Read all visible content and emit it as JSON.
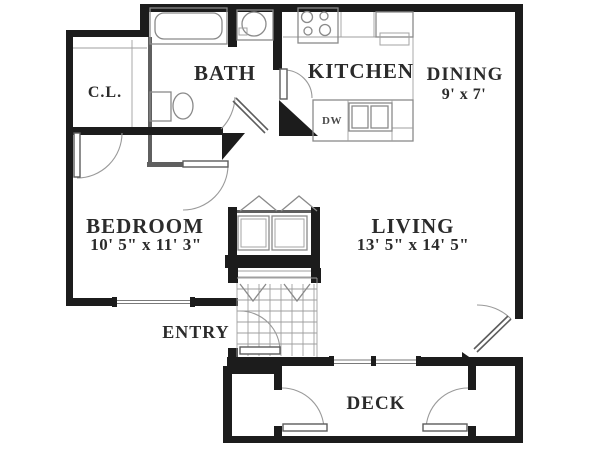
{
  "figure": {
    "type": "apartment-floor-plan"
  },
  "colors": {
    "background": "#ffffff",
    "wall": "#1c1c1c",
    "partition": "#5f5f5f",
    "fixture_line": "#8a8a8a",
    "door_arc": "#9a9a9a",
    "label_text": "#2b2b2b"
  },
  "rooms": {
    "closet": {
      "label": "C.L."
    },
    "bath": {
      "label": "BATH"
    },
    "kitchen": {
      "label": "KITCHEN"
    },
    "dining": {
      "label": "DINING",
      "dimensions": "9' x 7'"
    },
    "bedroom": {
      "label": "BEDROOM",
      "dimensions": "10' 5\" x 11' 3\""
    },
    "living": {
      "label": "LIVING",
      "dimensions": "13' 5\" x 14' 5\""
    },
    "entry": {
      "label": "ENTRY"
    },
    "deck": {
      "label": "DECK"
    }
  },
  "fixtures": {
    "dishwasher": {
      "label": "DW"
    }
  }
}
